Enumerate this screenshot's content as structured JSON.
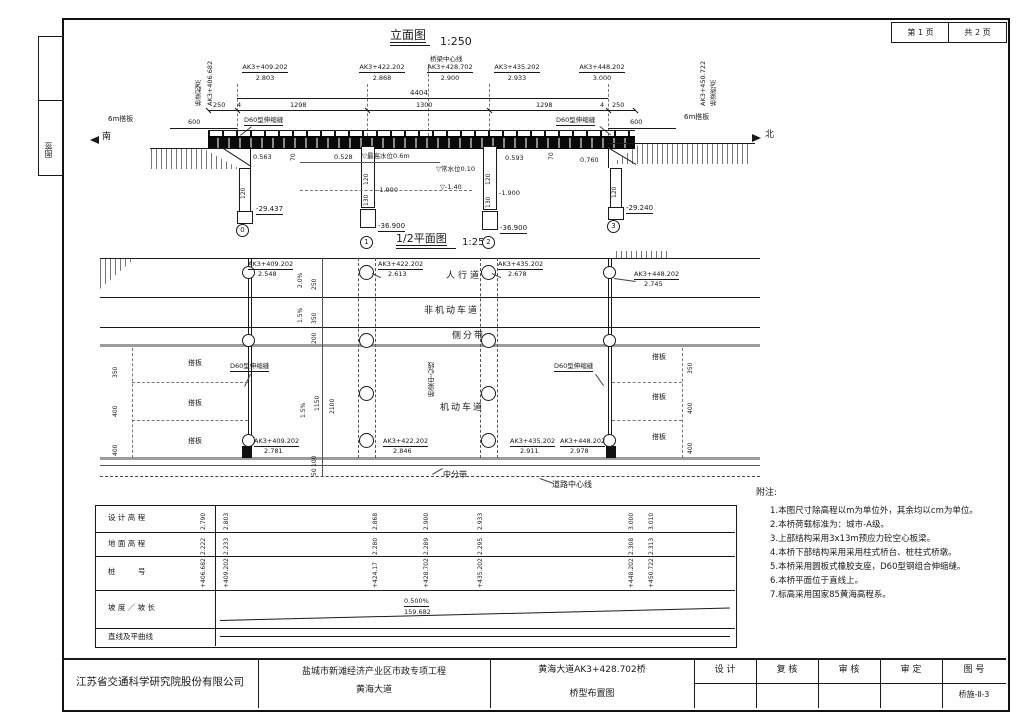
{
  "page": {
    "sheet_no": "第 1 页",
    "sheet_total": "共 2 页",
    "margin_label": "图签"
  },
  "elevation": {
    "title": "立面图",
    "scale": "1:250",
    "center_line": "桥梁中心线",
    "start": {
      "label": "桥梁起点",
      "station": "AK3+406.682"
    },
    "end": {
      "label": "桥梁终点",
      "station": "AK3+450.722"
    },
    "callouts": [
      {
        "station": "AK3+409.202",
        "value": "2.803"
      },
      {
        "station": "AK3+422.202",
        "value": "2.868"
      },
      {
        "station": "AK3+428.702",
        "value": "2.900"
      },
      {
        "station": "AK3+435.202",
        "value": "2.933"
      },
      {
        "station": "AK3+448.202",
        "value": "3.000"
      }
    ],
    "dims": {
      "total": "4404",
      "s1": "250",
      "s2": "4",
      "s3": "1298",
      "s4": "1300",
      "s5": "1298",
      "s6": "4",
      "s7": "250",
      "slab_left": "600",
      "slab_right": "600"
    },
    "slab_left": "6m搭板",
    "slab_right": "6m搭板",
    "joint_left": "D60型伸缩缝",
    "joint_right": "D60型伸缩缝",
    "south": "南",
    "north": "北",
    "levels": {
      "a0": "0.563",
      "p1": "0.528",
      "p2": "0.593",
      "a3": "0.760",
      "hwl": "▽最高水位0.6m",
      "nwl": "▽常水位0.10",
      "bed": "▽-1.40",
      "p1t": "-1.900",
      "p2t": "-1.900",
      "a0b": "-29.437",
      "p1b": "-36.900",
      "p2b": "-36.900",
      "a3b": "-29.240"
    },
    "member": {
      "a0w": "120",
      "p1w": "120",
      "p1w2": "130",
      "p2w": "120",
      "p2w2": "130",
      "a3w": "120",
      "cap1": "70",
      "cap2": "70"
    },
    "axis": {
      "a0": "0",
      "p1": "1",
      "p2": "2",
      "a3": "3"
    }
  },
  "plan": {
    "title": "1/2平面图",
    "scale": "1:250",
    "lanes": {
      "sidewalk": "人行道",
      "nonmotor": "非机动车道",
      "side_strip": "侧分带",
      "motor": "机动车道",
      "median": "中分带",
      "road_cl": "道路中心线",
      "bridge_cl": "桥梁中心线"
    },
    "top_callouts": [
      {
        "station": "AK3+409.202",
        "value": "2.548"
      },
      {
        "station": "AK3+422.202",
        "value": "2.613"
      },
      {
        "station": "AK3+435.202",
        "value": "2.678"
      },
      {
        "station": "AK3+448.202",
        "value": "2.745"
      }
    ],
    "bottom_callouts": [
      {
        "station": "AK3+409.202",
        "value": "2.781"
      },
      {
        "station": "AK3+422.202",
        "value": "2.846"
      },
      {
        "station": "AK3+435.202",
        "value": "2.911"
      },
      {
        "station": "AK3+448.202",
        "value": "2.978"
      }
    ],
    "joint_left": "D60型伸缩缝",
    "joint_right": "D60型伸缩缝",
    "slab": "搭板",
    "dims": {
      "w1": "250",
      "w2": "350",
      "w3": "200",
      "w4": "1150",
      "w5": "2100",
      "w6": "100",
      "w7": "50",
      "slab1": "350",
      "slab2": "400",
      "slab3": "400"
    },
    "slopes": {
      "s1": "2.0%",
      "s2": "1.5%",
      "s3": "1.5%"
    }
  },
  "profile_table": {
    "row_labels": [
      "设 计 高 程",
      "地 面 高 程",
      "桩　　　号",
      "坡 度 ／ 坡 长",
      "直线及平曲线"
    ],
    "columns": [
      {
        "design": "2.790",
        "ground": "2.222",
        "station": "+406.682"
      },
      {
        "design": "2.803",
        "ground": "2.233",
        "station": "+409.202"
      },
      {
        "design": "2.868",
        "ground": "2.280",
        "station": "+424.17"
      },
      {
        "design": "2.900",
        "ground": "2.289",
        "station": "+428.702"
      },
      {
        "design": "2.933",
        "ground": "2.295",
        "station": "+435.202"
      },
      {
        "design": "3.000",
        "ground": "2.308",
        "station": "+448.202"
      },
      {
        "design": "3.010",
        "ground": "2.313",
        "station": "+450.722"
      }
    ],
    "slope": {
      "grade": "0.500%",
      "length": "159.682"
    }
  },
  "notes": {
    "title": "附注:",
    "items": [
      "1.本图尺寸除高程以m为单位外，其余均以cm为单位。",
      "2.本桥荷载标准为：城市-A级。",
      "3.上部结构采用3x13m预应力砼空心板梁。",
      "4.本桥下部结构采用采用柱式桥台、桩柱式桥墩。",
      "5.本桥采用圆板式橡胶支座，D60型钢组合伸缩缝。",
      "6.本桥平面位于直线上。",
      "7.标高采用国家85黄海高程系。"
    ]
  },
  "title_block": {
    "company": "江苏省交通科学研究院股份有限公司",
    "project1": "盐城市新滩经济产业区市政专项工程",
    "project2": "黄海大道",
    "drawing1": "黄海大道AK3+428.702桥",
    "drawing2": "桥型布置图",
    "sig1": "设 计",
    "sig2": "复 核",
    "sig3": "审 核",
    "sig4": "审 定",
    "no_label": "图 号",
    "number": "桥施-Ⅱ-3"
  }
}
